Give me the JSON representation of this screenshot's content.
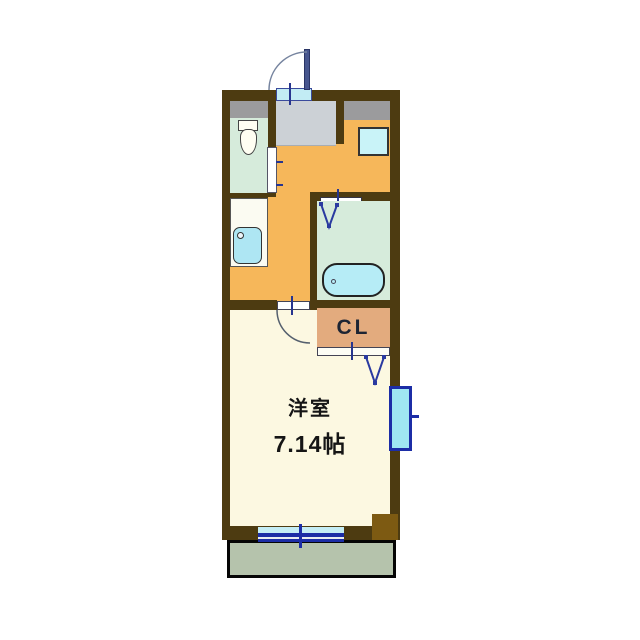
{
  "plan": {
    "type": "apartment-floor-plan",
    "labels": {
      "main_room_name": "洋室",
      "main_room_size": "7.14帖",
      "closet": "CL"
    },
    "rooms": [
      {
        "name": "entry",
        "floor_color": "#ccd1d6"
      },
      {
        "name": "toilet",
        "floor_color": "#d6ebdb"
      },
      {
        "name": "kitchen-hall",
        "floor_color": "#f6b75a"
      },
      {
        "name": "bathroom",
        "floor_color": "#d6ebdb"
      },
      {
        "name": "closet",
        "floor_color": "#e3ab7e"
      },
      {
        "name": "western-room",
        "floor_color": "#fcf8e1",
        "label": "洋室 7.14帖"
      },
      {
        "name": "balcony",
        "floor_color": "#b5c3ac"
      }
    ],
    "fixtures": [
      "entry-swing-door",
      "shoe-cabinet",
      "storage-cabinet",
      "toilet",
      "kitchen-counter-sink",
      "washing-machine-space",
      "bathroom-folding-door",
      "bathtub",
      "hallway-swing-door",
      "closet-folding-door",
      "sliding-window-balcony",
      "window-right",
      "corner-pillar"
    ],
    "colors": {
      "wall": "#4d3b11",
      "kitchen_floor": "#f6b75a",
      "room_floor": "#fcf8e1",
      "wet_area_floor": "#d6ebdb",
      "entry_floor": "#ccd1d6",
      "closet": "#e3ab7e",
      "balcony": "#b5c3ac",
      "water_fixture": "#aee6f3",
      "frame_blue": "#1c2da6",
      "pillar": "#7d5a12",
      "background": "#ffffff"
    }
  }
}
